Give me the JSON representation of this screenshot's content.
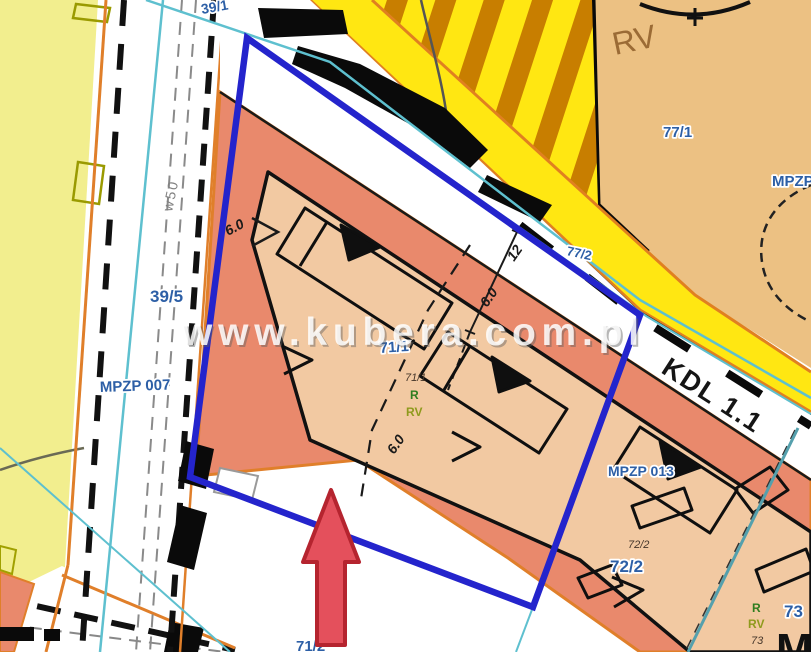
{
  "map": {
    "watermark": "www.kubera.com.pl",
    "parcels": {
      "p39_1": "39/1",
      "p39_5": "39/5",
      "p71_1": "71/1",
      "p71_1_small": "71/1",
      "p71_2": "71/2",
      "p72_2": "72/2",
      "p72_2_small": "72/2",
      "p73": "73",
      "p73_small": "73",
      "p77_1": "77/1",
      "p77_2": "77/2"
    },
    "plans": {
      "mpzp_007": "MPZP 007",
      "mpzp_013": "MPZP 013",
      "mpzp_right_partial": "MPZP",
      "road_class": "KDL 1.1",
      "zone_m_partial": "M"
    },
    "soil": {
      "r_center": "R",
      "rv_center": "RV",
      "r_right": "R",
      "rv_right": "RV",
      "n73_small": "73",
      "rv_topright": "RV"
    },
    "utilities": {
      "w50": "w50"
    },
    "dimensions": {
      "d6_left": "6.0",
      "d6_mid": "6.0",
      "d6_bottom": "6.0",
      "d12": "12"
    },
    "colors": {
      "selection_blue": "#2424cc",
      "arrow_red": "#e4505c",
      "road_yellow": "#ffe712",
      "hatch_brown": "#c87e00",
      "parcel_salmon": "#e9896c",
      "parcel_tan": "#f2c9a2",
      "soil_tan": "#ecc183",
      "zone_yellow": "#f2ee8e",
      "line_orange": "#e07f2a",
      "line_cyan": "#5ec0cf",
      "label_blue": "#2d5fa6"
    }
  }
}
